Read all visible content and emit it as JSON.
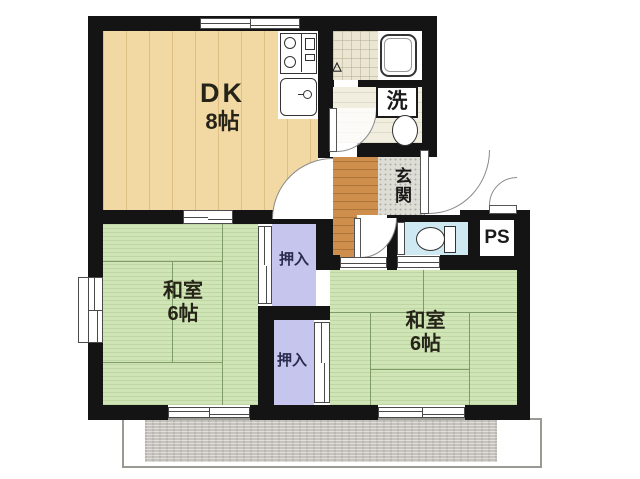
{
  "floorplan": {
    "rooms": {
      "dk": {
        "label": "DK",
        "size": "8帖"
      },
      "washitsu_left": {
        "label": "和室",
        "size": "6帖"
      },
      "washitsu_right": {
        "label": "和室",
        "size": "6帖"
      },
      "closet_top": {
        "label": "押入"
      },
      "closet_bottom": {
        "label": "押入"
      },
      "genkan": {
        "label": "玄関"
      },
      "laundry": {
        "label": "洗"
      },
      "pipe_space": {
        "label": "PS"
      }
    },
    "icons": [
      "stove-icon",
      "kitchen-sink-icon",
      "bathtub-icon",
      "bath-door-triangle-icon",
      "washbasin-icon",
      "toilet-icon",
      "door-swing-icon",
      "sliding-window-icon"
    ],
    "colors": {
      "wall": "#141414",
      "dk_floor": "#f2d9a4",
      "tatami": "#cfe5b5",
      "closet": "#c5c5ee",
      "hall_floor": "#cf8f4c",
      "genkan_tile": "#dddcd5",
      "toilet_floor": "#cfe9f2",
      "washroom_floor": "#f1eee0",
      "bath_tile": "#eae6d2",
      "balcony_slab": "#c6c2bd"
    }
  }
}
